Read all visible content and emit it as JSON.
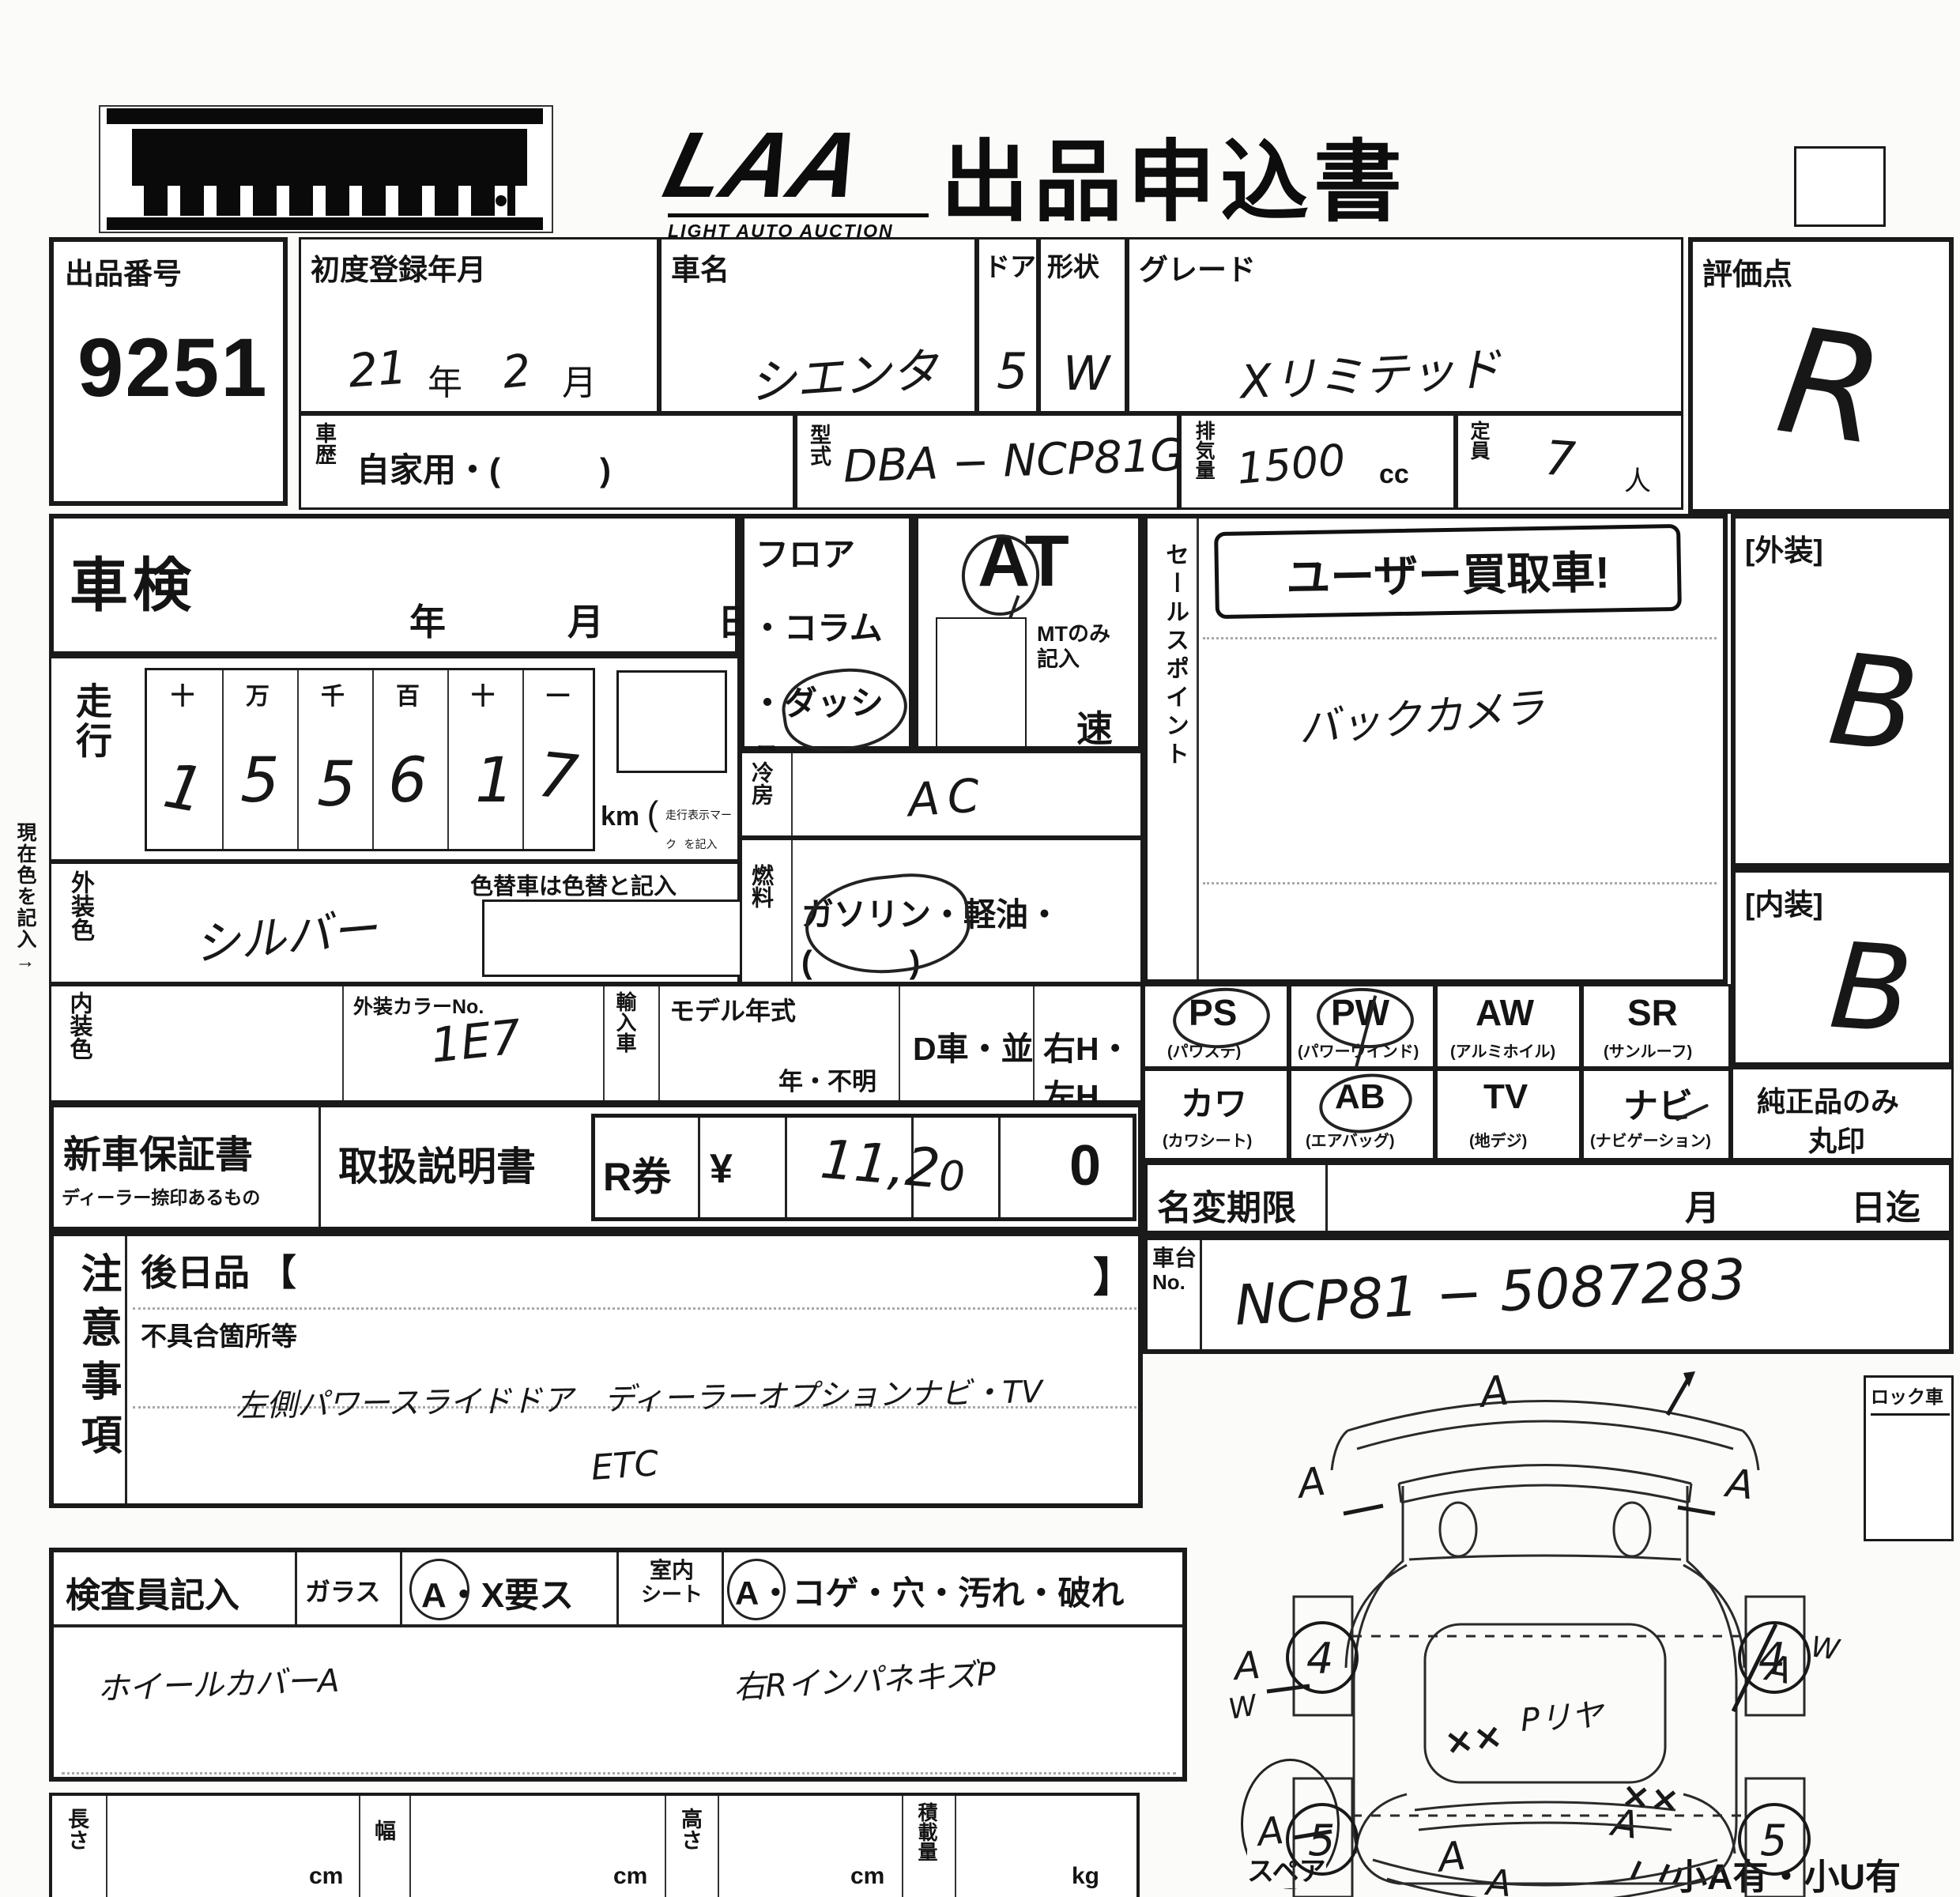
{
  "header": {
    "logo": "LAA",
    "logo_sub": "LIGHT AUTO AUCTION",
    "title": "出品申込書"
  },
  "top": {
    "lot_label": "出品番号",
    "lot_no": "9251",
    "first_reg_label": "初度登録年月",
    "first_reg_year": "21",
    "year_char": "年",
    "first_reg_month": "2",
    "month_char": "月",
    "car_name_label": "車名",
    "car_name": "シエンタ",
    "door_label": "ドア",
    "door": "5",
    "shape_label": "形状",
    "shape": "W",
    "grade_label": "グレード",
    "grade": "Xリミテッド",
    "score_label": "評価点",
    "score": "R",
    "history_label": "車歴",
    "history_value": "自家用・(　　　)",
    "model_code_label": "型式",
    "model_code": "DBA − NCP81G",
    "disp_label": "排気量",
    "disp": "1500",
    "disp_unit": "cc",
    "capacity_label": "定員",
    "capacity": "7",
    "capacity_unit": "人"
  },
  "inspection": {
    "label": "車検",
    "year": "年",
    "month": "月",
    "day": "日"
  },
  "mileage": {
    "label": "走行",
    "digits_header": [
      "十",
      "万",
      "千",
      "百",
      "十",
      "一"
    ],
    "digits": [
      "1",
      "5",
      "5",
      "6",
      "1",
      "7"
    ],
    "unit": "km",
    "unit_note1": "走行表示マーク",
    "unit_note2": "を記入"
  },
  "colors": {
    "current_note": "現在色を記入→",
    "ext_label": "外装色",
    "ext": "シルバー",
    "repaint_note": "色替車は色替と記入",
    "int_label": "内装色",
    "color_no_label": "外装カラーNo.",
    "color_no": "1E7",
    "import_label": "輸入車",
    "model_year_label": "モデル年式",
    "model_year_opts": "年・不明",
    "d_car": "D車・並",
    "handle": "右H・左H"
  },
  "drivetrain": {
    "floor": "フロア",
    "column": "・コラム",
    "dash": "・ダッシュ",
    "at": "AT",
    "mt_note1": "MTのみ",
    "mt_note2": "記入",
    "speed": "速",
    "ac_label": "冷房",
    "ac": "AC",
    "fuel_label": "燃料",
    "fuel": "ガソリン・軽油・(　　　)"
  },
  "sales": {
    "label": "セールスポイント",
    "stamp": "ユーザー買取車!",
    "point": "バックカメラ"
  },
  "ratings": {
    "ext_label": "[外装]",
    "ext": "B",
    "int_label": "[内装]",
    "int": "B",
    "genuine1": "純正品のみ",
    "genuine2": "丸印"
  },
  "options": {
    "r1": [
      {
        "code": "PS",
        "name": "(パワステ)"
      },
      {
        "code": "PW",
        "name": "(パワーウインド)"
      },
      {
        "code": "AW",
        "name": "(アルミホイル)"
      },
      {
        "code": "SR",
        "name": "(サンルーフ)"
      }
    ],
    "r2": [
      {
        "code": "カワ",
        "name": "(カワシート)"
      },
      {
        "code": "AB",
        "name": "(エアバッグ)"
      },
      {
        "code": "TV",
        "name": "(地デジ)"
      },
      {
        "code": "ナビ",
        "name": "(ナビゲーション)"
      }
    ]
  },
  "docs": {
    "warranty": "新車保証書",
    "warranty_sub": "ディーラー捺印あるもの",
    "manual": "取扱説明書",
    "rticket": "R券",
    "yen": "¥",
    "amount_a": "11,2",
    "amount_b": "0",
    "amount_c": "0"
  },
  "transfer": {
    "label": "名変期限",
    "month": "月",
    "until": "日迄"
  },
  "chassis": {
    "label1": "車台",
    "label2": "No.",
    "value": "NCP81 − 5087283"
  },
  "notes": {
    "label": "注意事項",
    "later_label": "後日品 【",
    "later_close": "】",
    "defect_label": "不具合箇所等",
    "line1": "左側パワースライドドア　ディーラーオプションナビ・TV",
    "line2": "ETC"
  },
  "inspector": {
    "label": "検査員記入",
    "glass_label": "ガラス",
    "glass_opts": "A・X要ス",
    "seat_label1": "室内",
    "seat_label2": "シート",
    "seat_opts": "A・コゲ・穴・汚れ・破れ",
    "hw1": "ホイールカバーA",
    "hw2": "右RインパネキズP"
  },
  "dims": {
    "length": "長さ",
    "width": "幅",
    "height": "高さ",
    "cm": "cm",
    "load": "積載量",
    "kg": "kg",
    "spare": "スペア",
    "small_note": "小A有・小U有",
    "lock": "ロック車"
  },
  "diagram": {
    "mark_a": "A",
    "mark_w": "W",
    "mark_xx": "××",
    "front_wheel": "4",
    "rear_wheel": "5",
    "center": "Pリヤ"
  }
}
